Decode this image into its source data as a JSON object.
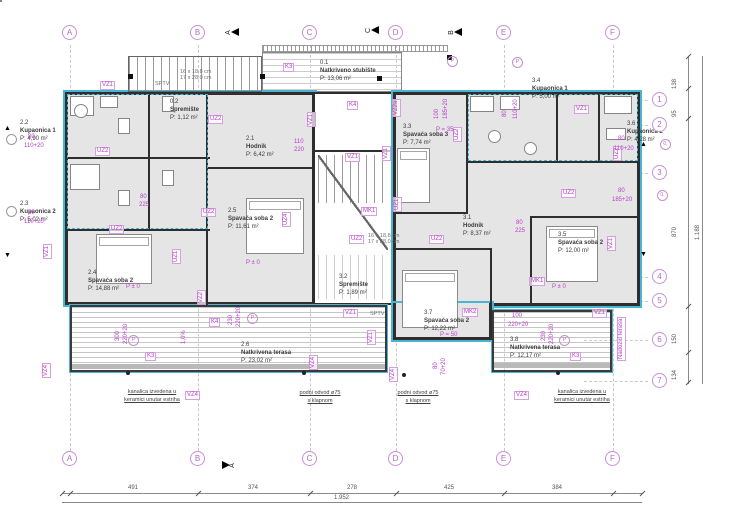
{
  "palette": {
    "accent_cyan": "#4ab5d3",
    "annotation_magenta": "#b93ec8",
    "grid_bubble": "#b06cc4",
    "wall": "#2e2e2e",
    "room_fill": "#e5e5e5",
    "dim_gray": "#555555"
  },
  "grid": {
    "cols": [
      {
        "label": "A",
        "x": 70
      },
      {
        "label": "B",
        "x": 198
      },
      {
        "label": "C",
        "x": 310
      },
      {
        "label": "D",
        "x": 396
      },
      {
        "label": "E",
        "x": 504
      },
      {
        "label": "F",
        "x": 613
      }
    ],
    "rows": [
      {
        "label": "1",
        "y": 100
      },
      {
        "label": "2",
        "y": 125
      },
      {
        "label": "3",
        "y": 173
      },
      {
        "label": "4",
        "y": 277
      },
      {
        "label": "5",
        "y": 301
      },
      {
        "label": "6",
        "y": 340
      },
      {
        "label": "7",
        "y": 381
      }
    ]
  },
  "rooms": [
    {
      "id": "2.2",
      "name": "Kupaonica 1",
      "area": "P: 4,90 m²",
      "x": 20,
      "y": 120
    },
    {
      "id": "2.3",
      "name": "Kupaonica 2",
      "area": "P: 5,02 m²",
      "x": 20,
      "y": 201
    },
    {
      "id": "2.1",
      "name": "Hodnik",
      "area": "P: 6,42 m²",
      "x": 246,
      "y": 136
    },
    {
      "id": "2.5",
      "name": "Spavaća soba 2",
      "area": "P: 11,61 m²",
      "x": 228,
      "y": 208
    },
    {
      "id": "2.4",
      "name": "Spavaća soba 2",
      "area": "P: 14,88 m²",
      "x": 88,
      "y": 270
    },
    {
      "id": "2.6",
      "name": "Natkrivena terasa",
      "area": "P: 23,02 m²",
      "x": 241,
      "y": 342
    },
    {
      "id": "0.1",
      "name": "Natkriveno stubište",
      "area": "P: 13,06 m²",
      "x": 320,
      "y": 60
    },
    {
      "id": "0.2",
      "name": "Spremište",
      "area": "P: 1,12 m²",
      "x": 170,
      "y": 99
    },
    {
      "id": "3.2",
      "name": "Spremište",
      "area": "P: 1,89 m²",
      "x": 339,
      "y": 274
    },
    {
      "id": "3.3",
      "name": "Spavaća soba 3",
      "area": "P: 7,74 m²",
      "x": 403,
      "y": 124
    },
    {
      "id": "3.4",
      "name": "Kupaonica 1",
      "area": "P: 5,00 m²",
      "x": 532,
      "y": 78
    },
    {
      "id": "3.6",
      "name": "Kupaonica 2",
      "area": "P: 4,28 m²",
      "x": 627,
      "y": 121
    },
    {
      "id": "3.1",
      "name": "Hodnik",
      "area": "P: 8,37 m²",
      "x": 463,
      "y": 215
    },
    {
      "id": "3.5",
      "name": "Spavaća soba 2",
      "area": "P: 12,00 m²",
      "x": 558,
      "y": 232
    },
    {
      "id": "3.7",
      "name": "Spavaća soba 2",
      "area": "P: 12,22 m²",
      "x": 424,
      "y": 310
    },
    {
      "id": "3.8",
      "name": "Natkrivena terasa",
      "area": "P: 12,17 m²",
      "x": 510,
      "y": 337
    }
  ],
  "tags": [
    {
      "t": "VZ1",
      "x": 100,
      "y": 81
    },
    {
      "t": "VZ1",
      "x": 345,
      "y": 153
    },
    {
      "t": "VZ1",
      "x": 574,
      "y": 105
    },
    {
      "t": "VZ1",
      "x": 316,
      "y": 118,
      "v": 1
    },
    {
      "t": "VZ1",
      "x": 391,
      "y": 152,
      "v": 1
    },
    {
      "t": "VZ1",
      "x": 52,
      "y": 250,
      "v": 1
    },
    {
      "t": "VZ1",
      "x": 616,
      "y": 242,
      "v": 1
    },
    {
      "t": "VZ1",
      "x": 343,
      "y": 309
    },
    {
      "t": "VZ1",
      "x": 592,
      "y": 309
    },
    {
      "t": "VZ1",
      "x": 376,
      "y": 336,
      "v": 1
    },
    {
      "t": "VZ2",
      "x": 206,
      "y": 296,
      "v": 1
    },
    {
      "t": "VZ2a",
      "x": 401,
      "y": 108,
      "v": 1
    },
    {
      "t": "VZ4",
      "x": 51,
      "y": 369,
      "v": 1
    },
    {
      "t": "VZ4",
      "x": 185,
      "y": 391
    },
    {
      "t": "VZ4",
      "x": 318,
      "y": 361,
      "v": 1
    },
    {
      "t": "VZ4",
      "x": 398,
      "y": 373,
      "v": 1
    },
    {
      "t": "VZ4",
      "x": 514,
      "y": 391
    },
    {
      "t": "UZ2",
      "x": 95,
      "y": 147
    },
    {
      "t": "UZ2",
      "x": 109,
      "y": 225
    },
    {
      "t": "UZ2",
      "x": 201,
      "y": 208
    },
    {
      "t": "UZ2",
      "x": 208,
      "y": 115
    },
    {
      "t": "UZ2",
      "x": 349,
      "y": 235
    },
    {
      "t": "UZ2",
      "x": 429,
      "y": 235
    },
    {
      "t": "UZ2",
      "x": 561,
      "y": 189
    },
    {
      "t": "UZ2",
      "x": 622,
      "y": 152,
      "v": 1
    },
    {
      "t": "UZ2",
      "x": 462,
      "y": 133,
      "v": 1
    },
    {
      "t": "UZ1",
      "x": 181,
      "y": 255,
      "v": 1
    },
    {
      "t": "UZ1",
      "x": 402,
      "y": 203,
      "v": 1
    },
    {
      "t": "UZ4",
      "x": 291,
      "y": 218,
      "v": 1
    },
    {
      "t": "MK1",
      "x": 361,
      "y": 207
    },
    {
      "t": "MK1",
      "x": 529,
      "y": 277
    },
    {
      "t": "MK2",
      "x": 462,
      "y": 308
    },
    {
      "t": "K3",
      "x": 283,
      "y": 63
    },
    {
      "t": "K3",
      "x": 145,
      "y": 352
    },
    {
      "t": "K3",
      "x": 570,
      "y": 352
    },
    {
      "t": "K4",
      "x": 347,
      "y": 101
    },
    {
      "t": "K4",
      "x": 209,
      "y": 318
    },
    {
      "t": "Nadozid terasa",
      "x": 626,
      "y": 352,
      "v": 1
    }
  ],
  "dims": [
    {
      "t": "80",
      "x": 28,
      "y": 134
    },
    {
      "t": "110+20",
      "x": 24,
      "y": 143
    },
    {
      "t": "80",
      "x": 28,
      "y": 210
    },
    {
      "t": "110+20",
      "x": 24,
      "y": 219
    },
    {
      "t": "80",
      "x": 618,
      "y": 136
    },
    {
      "t": "110+20",
      "x": 614,
      "y": 146
    },
    {
      "t": "80",
      "x": 618,
      "y": 188
    },
    {
      "t": "185+20",
      "x": 612,
      "y": 197
    },
    {
      "t": "110+20",
      "x": 520,
      "y": 112,
      "v": 1
    },
    {
      "t": "80",
      "x": 509,
      "y": 110,
      "v": 1
    },
    {
      "t": "185+20",
      "x": 450,
      "y": 112,
      "v": 1
    },
    {
      "t": "100",
      "x": 441,
      "y": 112,
      "v": 1
    },
    {
      "t": "100",
      "x": 512,
      "y": 313
    },
    {
      "t": "220+20",
      "x": 508,
      "y": 322
    },
    {
      "t": "220+20",
      "x": 556,
      "y": 337,
      "v": 1
    },
    {
      "t": "230",
      "x": 548,
      "y": 334,
      "v": 1
    },
    {
      "t": "220+20",
      "x": 130,
      "y": 337,
      "v": 1
    },
    {
      "t": "300",
      "x": 122,
      "y": 334,
      "v": 1
    },
    {
      "t": "220+20",
      "x": 243,
      "y": 320,
      "v": 1
    },
    {
      "t": "230",
      "x": 235,
      "y": 318,
      "v": 1
    },
    {
      "t": "110",
      "x": 294,
      "y": 139
    },
    {
      "t": "220",
      "x": 294,
      "y": 147
    },
    {
      "t": "80",
      "x": 140,
      "y": 194
    },
    {
      "t": "225",
      "x": 139,
      "y": 202
    },
    {
      "t": "80",
      "x": 516,
      "y": 220
    },
    {
      "t": "225",
      "x": 515,
      "y": 228
    },
    {
      "t": "80",
      "x": 440,
      "y": 362,
      "v": 1
    },
    {
      "t": "70+20",
      "x": 448,
      "y": 368,
      "v": 1
    },
    {
      "t": "1,0%",
      "x": 188,
      "y": 337,
      "v": 1
    },
    {
      "t": "P ± 0",
      "x": 126,
      "y": 284
    },
    {
      "t": "P ± 0",
      "x": 246,
      "y": 260
    },
    {
      "t": "P ± 0",
      "x": 552,
      "y": 284
    },
    {
      "t": "P = 35",
      "x": 436,
      "y": 127
    },
    {
      "t": "P = 50",
      "x": 440,
      "y": 332
    }
  ],
  "gray_texts": [
    {
      "t": "SPTV",
      "x": 155,
      "y": 81
    },
    {
      "t": "SPTV",
      "x": 370,
      "y": 311
    },
    {
      "t": "16 x 18,8 cm",
      "x": 180,
      "y": 69
    },
    {
      "t": "17 x 28,0 cm",
      "x": 180,
      "y": 75
    },
    {
      "t": "16 x 18,8 cm",
      "x": 368,
      "y": 233
    },
    {
      "t": "17 x 28,0 cm",
      "x": 368,
      "y": 239
    }
  ],
  "notes": [
    {
      "lines": [
        "kanalica izvedena u",
        "keramici unutar estriha"
      ],
      "x": 152,
      "y": 388
    },
    {
      "lines": [
        "podni odvod ø75",
        "s klapnom"
      ],
      "x": 320,
      "y": 389
    },
    {
      "lines": [
        "podni odvod ø75",
        "s klapnom"
      ],
      "x": 418,
      "y": 389
    },
    {
      "lines": [
        "kanalica izvedena u",
        "keramici unutar estriha"
      ],
      "x": 582,
      "y": 388
    }
  ],
  "section_markers": [
    {
      "label": "A",
      "x": 226,
      "y": 28,
      "flip": 0
    },
    {
      "label": "C",
      "x": 366,
      "y": 26,
      "flip": 0
    },
    {
      "label": "B",
      "x": 449,
      "y": 28,
      "flip": 0
    },
    {
      "label": "A",
      "x": 222,
      "y": 461,
      "flip": 1
    }
  ],
  "level_markers": [
    {
      "s": "▲",
      "l": "1",
      "x": 640,
      "y": 141
    },
    {
      "s": "▼",
      "l": "2",
      "x": 640,
      "y": 251
    },
    {
      "s": "▲",
      "l": "",
      "x": 4,
      "y": 125
    },
    {
      "s": "▼",
      "l": "",
      "x": 4,
      "y": 252
    }
  ],
  "ref_circles": [
    {
      "t": "P",
      "x": 447,
      "y": 56
    },
    {
      "t": "P",
      "x": 512,
      "y": 57
    },
    {
      "t": "P",
      "x": 128,
      "y": 335
    },
    {
      "t": "P",
      "x": 559,
      "y": 335
    },
    {
      "t": "P",
      "x": 247,
      "y": 313
    },
    {
      "t": "0,",
      "x": 660,
      "y": 139
    },
    {
      "t": "0,",
      "x": 657,
      "y": 190
    },
    {
      "t": "",
      "x": 6,
      "y": 134
    },
    {
      "t": "",
      "x": 6,
      "y": 206
    }
  ],
  "dim_chain_bottom": {
    "y": 493,
    "x1": 62,
    "x2": 642,
    "ticks": [
      62,
      70,
      198,
      310,
      396,
      504,
      613,
      642
    ],
    "values": [
      {
        "t": "491",
        "x": 128
      },
      {
        "t": "374",
        "x": 248
      },
      {
        "t": "278",
        "x": 347
      },
      {
        "t": "425",
        "x": 444
      },
      {
        "t": "384",
        "x": 552
      }
    ],
    "total": {
      "t": "1.952",
      "x": 334,
      "y": 495
    }
  },
  "dim_chain_right": {
    "x": 688,
    "y1": 56,
    "y2": 384,
    "ticks": [
      56,
      88,
      118,
      306,
      352,
      382
    ],
    "values": [
      {
        "t": "138",
        "y": 82
      },
      {
        "t": "95",
        "y": 110
      },
      {
        "t": "870",
        "y": 230
      },
      {
        "t": "150",
        "y": 337
      },
      {
        "t": "134",
        "y": 373
      }
    ],
    "total": {
      "t": "1.188",
      "x": 702,
      "y": 233
    }
  }
}
